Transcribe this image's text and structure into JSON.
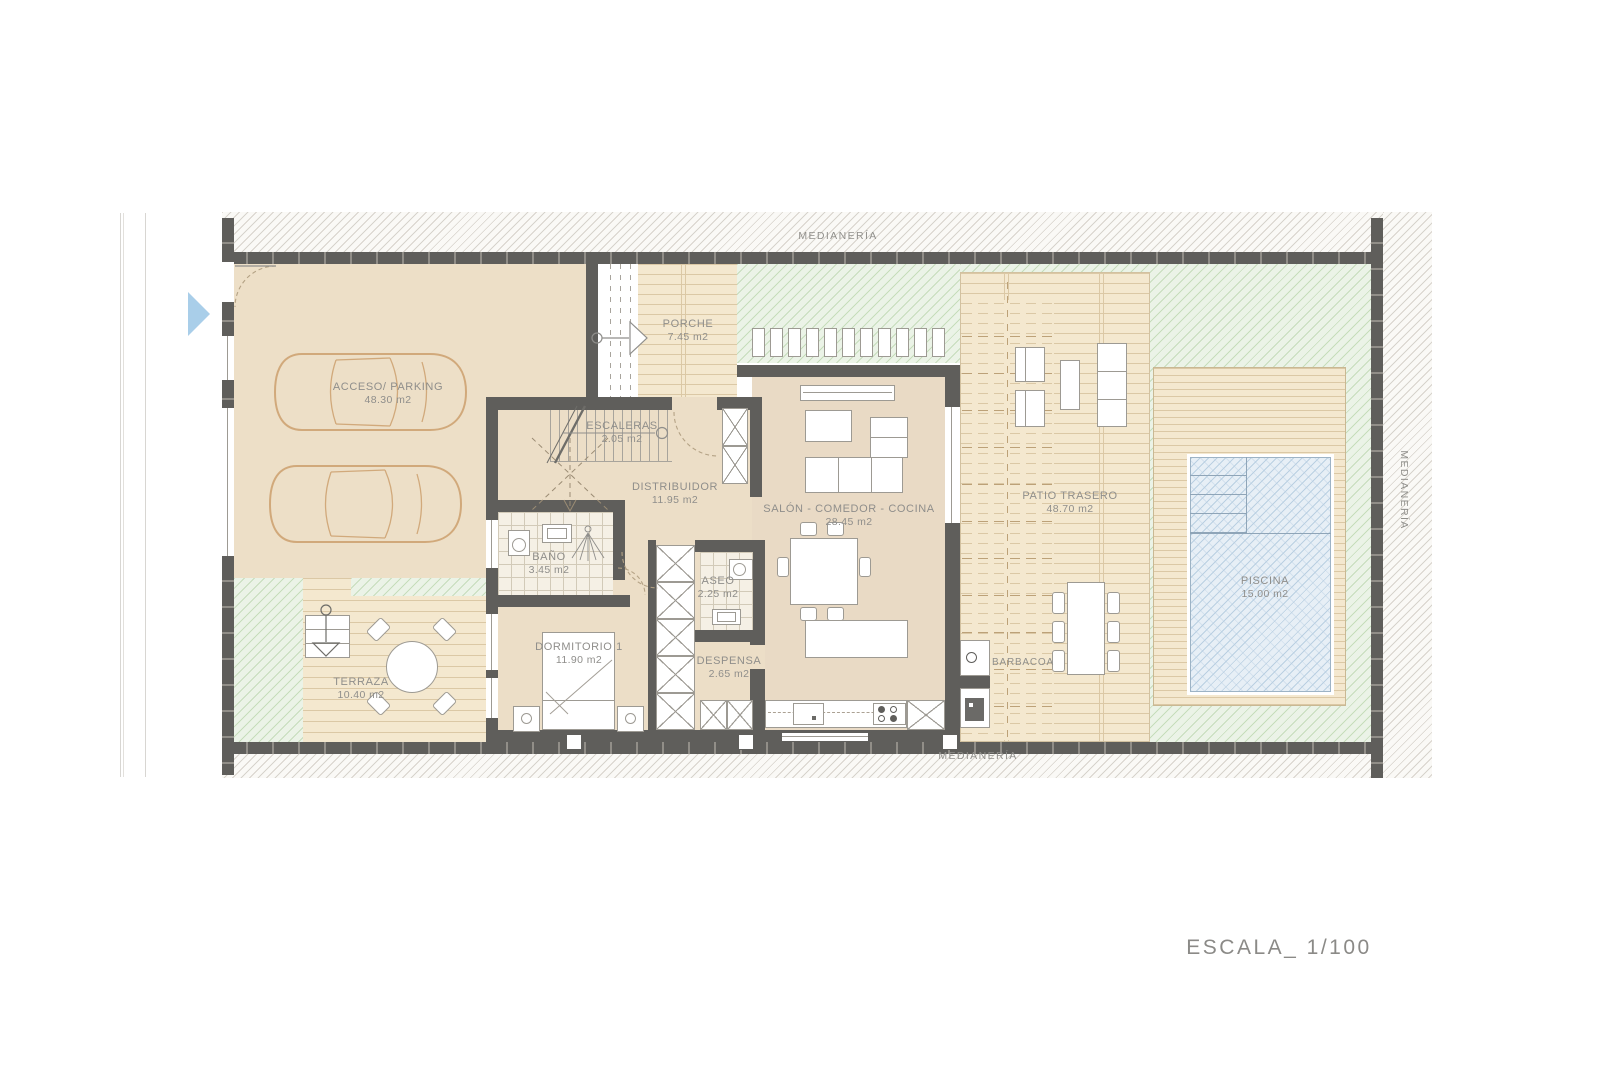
{
  "plan": {
    "scale": "ESCALA_ 1/100",
    "boundaries": {
      "top": "MEDIANERÍA",
      "bottom": "MEDIANERÍA",
      "right": "MEDIANERÍA"
    },
    "rooms": {
      "parking": {
        "name": "ACCESO/ PARKING",
        "area": "48.30 m2"
      },
      "porche": {
        "name": "PORCHE",
        "area": "7.45 m2"
      },
      "escaleras": {
        "name": "ESCALERAS",
        "area": "2.05 m2"
      },
      "distribuidor": {
        "name": "DISTRIBUIDOR",
        "area": "11.95 m2"
      },
      "salon": {
        "name": "SALÓN - COMEDOR - COCINA",
        "area": "28.45 m2"
      },
      "bano": {
        "name": "BAÑO",
        "area": "3.45 m2"
      },
      "aseo": {
        "name": "ASEO",
        "area": "2.25 m2"
      },
      "dormitorio": {
        "name": "DORMITORIO 1",
        "area": "11.90 m2"
      },
      "despensa": {
        "name": "DESPENSA",
        "area": "2.65 m2"
      },
      "terraza": {
        "name": "TERRAZA",
        "area": "10.40 m2"
      },
      "patio": {
        "name": "PATIO TRASERO",
        "area": "48.70 m2"
      },
      "piscina": {
        "name": "PISCINA",
        "area": "15.00 m2"
      },
      "barbacoa": {
        "name": "BARBACOA"
      }
    },
    "colors": {
      "wall": "#5f5e5b",
      "floor": "#ebddc5",
      "deck": "#f4e8cf",
      "deck_line": "#dbc8a5",
      "green": "#ebf3e7",
      "green_line": "#c6ddbb",
      "pool": "#e7eff6",
      "pool_line": "#bad0e2",
      "label": "#8f8e8b",
      "car_outline": "#d1a97b",
      "nav_arrow": "#a9cee9"
    }
  }
}
